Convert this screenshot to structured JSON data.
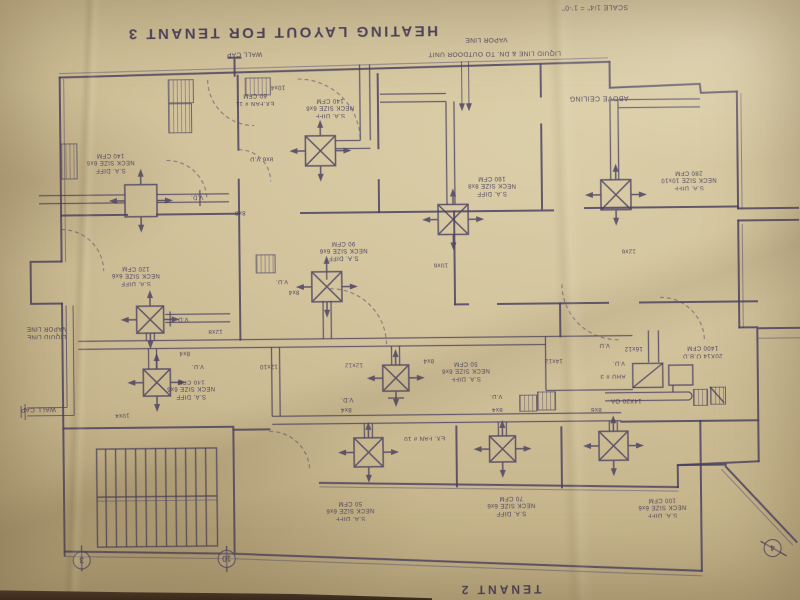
{
  "drawing": {
    "title": "HEATING LAYOUT FOR TENANT 3",
    "scale_note": "SCALE 1/4\" = 1'-0\"",
    "adjacent_tenant_label": "TENANT 2",
    "orientation": "sheet photographed rotated 180 degrees",
    "paper_color": "#d2c39c",
    "ink_color": "#473e60"
  },
  "labels": [
    {
      "n": "wall-cap-label-top",
      "t": "WALL CAP",
      "x": 247,
      "y": 52,
      "w": 60,
      "s": 6.5
    },
    {
      "n": "vapor-line-label-top",
      "t": "VAPOR LINE",
      "x": 489,
      "y": 40,
      "w": 70,
      "s": 6.5
    },
    {
      "n": "liquid-line-label-top",
      "t": "LIQUID LINE & DN. TO OUTDOOR UNIT",
      "x": 497,
      "y": 54,
      "w": 178,
      "s": 6.5
    },
    {
      "n": "above-ceiling-label",
      "t": "ABOVE CEILING",
      "x": 601,
      "y": 99,
      "w": 100,
      "s": 7
    },
    {
      "n": "exhaust-fan-11-label",
      "t": "EX.FAN # 11\n60 CFM",
      "x": 257,
      "y": 97,
      "w": 70,
      "s": 6
    },
    {
      "n": "duct-size-label",
      "t": "10x4",
      "x": 280,
      "y": 85,
      "w": 34,
      "s": 6
    },
    {
      "n": "diffuser-tag",
      "t": "S.A. DIFF\nNECK SIZE 6x6\n140 CFM",
      "x": 332,
      "y": 106,
      "w": 80,
      "s": 6
    },
    {
      "n": "duct-size-label",
      "t": "8x6 V.D",
      "x": 263,
      "y": 156,
      "w": 46,
      "s": 6
    },
    {
      "n": "diffuser-tag",
      "t": "S.A. DIFF\nNECK SIZE 6x6\n140 CFM",
      "x": 112,
      "y": 159,
      "w": 80,
      "s": 6
    },
    {
      "n": "damper-label",
      "t": "V.D.",
      "x": 198,
      "y": 194,
      "w": 26,
      "s": 6
    },
    {
      "n": "duct-size-label",
      "t": "8x8",
      "x": 241,
      "y": 210,
      "w": 26,
      "s": 6
    },
    {
      "n": "diffuser-tag",
      "t": "S.A. DIFF\nNECK SIZE 6x6\n90 CFM",
      "x": 344,
      "y": 249,
      "w": 80,
      "s": 6
    },
    {
      "n": "damper-label",
      "t": "V.D.",
      "x": 282,
      "y": 279,
      "w": 26,
      "s": 6
    },
    {
      "n": "duct-size-label",
      "t": "8x4",
      "x": 294,
      "y": 290,
      "w": 26,
      "s": 6
    },
    {
      "n": "diffuser-tag",
      "t": "S.A. DIFF\nNECK SIZE 6x6\n120 CFM",
      "x": 136,
      "y": 272,
      "w": 80,
      "s": 6
    },
    {
      "n": "damper-label",
      "t": "V.D",
      "x": 183,
      "y": 316,
      "w": 24,
      "s": 6
    },
    {
      "n": "duct-size-label",
      "t": "12x8",
      "x": 215,
      "y": 328,
      "w": 30,
      "s": 6
    },
    {
      "n": "duct-size-label",
      "t": "10x6",
      "x": 441,
      "y": 264,
      "w": 30,
      "s": 6
    },
    {
      "n": "duct-size-label",
      "t": "12x6",
      "x": 629,
      "y": 252,
      "w": 30,
      "s": 6
    },
    {
      "n": "diffuser-tag",
      "t": "S.A. DIFF\nNECK SIZE 8x8\n190 CFM",
      "x": 493,
      "y": 186,
      "w": 82,
      "s": 6
    },
    {
      "n": "diffuser-tag",
      "t": "S.A. DIFF\nNECK SIZE 10x10\n280 CFM",
      "x": 690,
      "y": 182,
      "w": 90,
      "s": 6
    },
    {
      "n": "refrigerant-lines-label-left",
      "t": "LIQUID LINE\nVAPOR LINE",
      "x": 46,
      "y": 328,
      "w": 64,
      "s": 6
    },
    {
      "n": "wall-cap-label-left",
      "t": "WALL CAP",
      "x": 37,
      "y": 405,
      "w": 58,
      "s": 6.5
    },
    {
      "n": "duct-size-label",
      "t": "8x4",
      "x": 184,
      "y": 350,
      "w": 26,
      "s": 6
    },
    {
      "n": "damper-label",
      "t": "V.D.",
      "x": 197,
      "y": 363,
      "w": 26,
      "s": 6
    },
    {
      "n": "diffuser-tag",
      "t": "S.A. DIFF\nNECK SIZE 6x6\n140 CFM",
      "x": 190,
      "y": 386,
      "w": 80,
      "s": 6
    },
    {
      "n": "duct-size-label",
      "t": "10x4",
      "x": 121,
      "y": 411,
      "w": 34,
      "s": 6
    },
    {
      "n": "duct-size-label",
      "t": "12x10",
      "x": 268,
      "y": 364,
      "w": 38,
      "s": 6
    },
    {
      "n": "duct-size-label",
      "t": "12x12",
      "x": 353,
      "y": 363,
      "w": 38,
      "s": 6
    },
    {
      "n": "duct-size-label",
      "t": "8x4",
      "x": 428,
      "y": 360,
      "w": 26,
      "s": 6
    },
    {
      "n": "diffuser-tag",
      "t": "S.A. DIFF\nNECK SIZE 6x6\n50 CFM",
      "x": 465,
      "y": 371,
      "w": 78,
      "s": 6
    },
    {
      "n": "duct-size-label",
      "t": "14x12",
      "x": 553,
      "y": 361,
      "w": 38,
      "s": 6
    },
    {
      "n": "damper-label",
      "t": "V.D.",
      "x": 346,
      "y": 398,
      "w": 24,
      "s": 6
    },
    {
      "n": "duct-size-label",
      "t": "8x4",
      "x": 345,
      "y": 408,
      "w": 26,
      "s": 6
    },
    {
      "n": "damper-label",
      "t": "V.D.",
      "x": 495,
      "y": 396,
      "w": 24,
      "s": 6
    },
    {
      "n": "duct-size-label",
      "t": "8x4",
      "x": 496,
      "y": 409,
      "w": 26,
      "s": 6
    },
    {
      "n": "duct-size-label",
      "t": "8x6",
      "x": 595,
      "y": 410,
      "w": 26,
      "s": 6
    },
    {
      "n": "damper-label",
      "t": "V.D",
      "x": 604,
      "y": 346,
      "w": 22,
      "s": 6
    },
    {
      "n": "duct-size-label",
      "t": "16x12",
      "x": 633,
      "y": 350,
      "w": 36,
      "s": 6
    },
    {
      "n": "damper-label",
      "t": "V.D.",
      "x": 618,
      "y": 364,
      "w": 24,
      "s": 6
    },
    {
      "n": "unit-label",
      "t": "AHU # 3",
      "x": 612,
      "y": 377,
      "w": 48,
      "s": 6
    },
    {
      "n": "damper-label",
      "t": "20X14 O.B.D\n1400 CFM",
      "x": 702,
      "y": 354,
      "w": 74,
      "s": 6
    },
    {
      "n": "outside-air-label",
      "t": "14X20 OA",
      "x": 625,
      "y": 402,
      "w": 56,
      "s": 6
    },
    {
      "n": "exhaust-fan-10-label",
      "t": "EX. FAN # 10",
      "x": 423,
      "y": 437,
      "w": 72,
      "s": 6
    },
    {
      "n": "diffuser-tag",
      "t": "S.A. DIFF\nNECK SIZE 6x6\n50 CFM",
      "x": 348,
      "y": 509,
      "w": 78,
      "s": 6
    },
    {
      "n": "diffuser-tag",
      "t": "S.A. DIFF\nNECK SIZE 6x6\n70 CFM",
      "x": 509,
      "y": 506,
      "w": 78,
      "s": 6
    },
    {
      "n": "diffuser-tag",
      "t": "S.A. DIFF\nNECK SIZE 6x6\n100 CFM",
      "x": 660,
      "y": 509,
      "w": 80,
      "s": 6
    }
  ],
  "diffusers": [
    {
      "x": 322,
      "y": 150,
      "s": 30,
      "xm": 1
    },
    {
      "x": 142,
      "y": 198,
      "s": 32,
      "xm": 0
    },
    {
      "x": 327,
      "y": 286,
      "s": 30,
      "xm": 1
    },
    {
      "x": 150,
      "y": 317,
      "s": 27,
      "xm": 1
    },
    {
      "x": 156,
      "y": 380,
      "s": 27,
      "xm": 1
    },
    {
      "x": 454,
      "y": 220,
      "s": 30,
      "xm": 1
    },
    {
      "x": 617,
      "y": 197,
      "s": 30,
      "xm": 1
    },
    {
      "x": 395,
      "y": 378,
      "s": 26,
      "xm": 1
    },
    {
      "x": 367,
      "y": 452,
      "s": 29,
      "xm": 1
    },
    {
      "x": 501,
      "y": 450,
      "s": 26,
      "xm": 1
    },
    {
      "x": 612,
      "y": 448,
      "s": 29,
      "xm": 1
    }
  ],
  "grilles": [
    {
      "x": 170,
      "y": 77,
      "w": 24,
      "h": 22
    },
    {
      "x": 170,
      "y": 101,
      "w": 22,
      "h": 28
    },
    {
      "x": 62,
      "y": 140,
      "w": 15,
      "h": 34
    },
    {
      "x": 256,
      "y": 253,
      "w": 18,
      "h": 17
    },
    {
      "x": 247,
      "y": 76,
      "w": 24,
      "h": 16
    },
    {
      "x": 518,
      "y": 396,
      "w": 16,
      "h": 15
    },
    {
      "x": 536,
      "y": 393,
      "w": 17,
      "h": 17
    },
    {
      "x": 692,
      "y": 392,
      "w": 13,
      "h": 15
    },
    {
      "x": 709,
      "y": 390,
      "w": 14,
      "h": 16
    }
  ],
  "grid_markers": [
    {
      "t": "3",
      "x": 79,
      "y": 557
    },
    {
      "t": "10",
      "x": 224,
      "y": 557
    },
    {
      "t": "4",
      "x": 770,
      "y": 552
    }
  ]
}
